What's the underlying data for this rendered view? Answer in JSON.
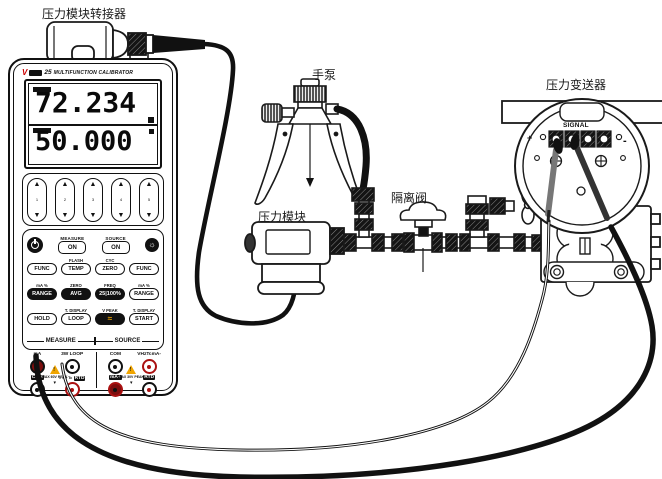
{
  "labels": {
    "adapter": "压力模块转接器",
    "hand_pump": "手泵",
    "pressure_transmitter": "压力变送器",
    "isolation_valve": "隔离阀",
    "pressure_module": "压力模块"
  },
  "transmitter": {
    "terminal_label": "SIGNAL",
    "plus": "+",
    "minus": "-"
  },
  "calibrator": {
    "model": "25",
    "title": "MULTIFUNCTION CALIBRATOR",
    "display": {
      "primary": "72.234",
      "secondary": "50.000"
    },
    "arrows": [
      "1",
      "2",
      "3",
      "4",
      "5"
    ],
    "controls": {
      "measure": "MEASURE",
      "source": "SOURCE",
      "on_measure": "ON",
      "on_source": "ON"
    },
    "hints1": [
      "",
      "FLASH",
      "CYC",
      ""
    ],
    "row1": [
      "FUNC",
      "TEMP",
      "ZERO",
      "FUNC"
    ],
    "hints2": [
      "mA %",
      "ZERO",
      "FREQ",
      "mA %"
    ],
    "row2": [
      "RANGE",
      "AVG",
      "25|100%",
      "RANGE"
    ],
    "hints3": [
      "",
      "T. DISPLAY",
      "V PEAK",
      "T. DISPLAY"
    ],
    "row3": [
      "HOLD",
      "LOOP",
      "START"
    ],
    "sections": {
      "measure": "MEASURE",
      "source": "SOURCE"
    },
    "terminals": {
      "measure": {
        "t1": "mA",
        "t2": "3W LOOP",
        "b1": "COM",
        "b2a": "V Hz Tc",
        "b2b": "RTD",
        "warn": "MAX 60V PEAK"
      },
      "source": {
        "t1": "COM",
        "t2": "VHzTcmA-",
        "b1": "mA+",
        "b2": "RTD",
        "warn": "MAX 30V PEAK"
      }
    }
  },
  "icons": {
    "warning": "!",
    "backlight": "☼",
    "wave": "≈",
    "polarity": "▾",
    "arrow_up": "▲",
    "arrow_down": "▼"
  },
  "colors": {
    "accent_red": "#cc0000",
    "warning_yellow": "#f0a500",
    "jack_red": "#aa1111",
    "line": "#1a1a1a"
  }
}
